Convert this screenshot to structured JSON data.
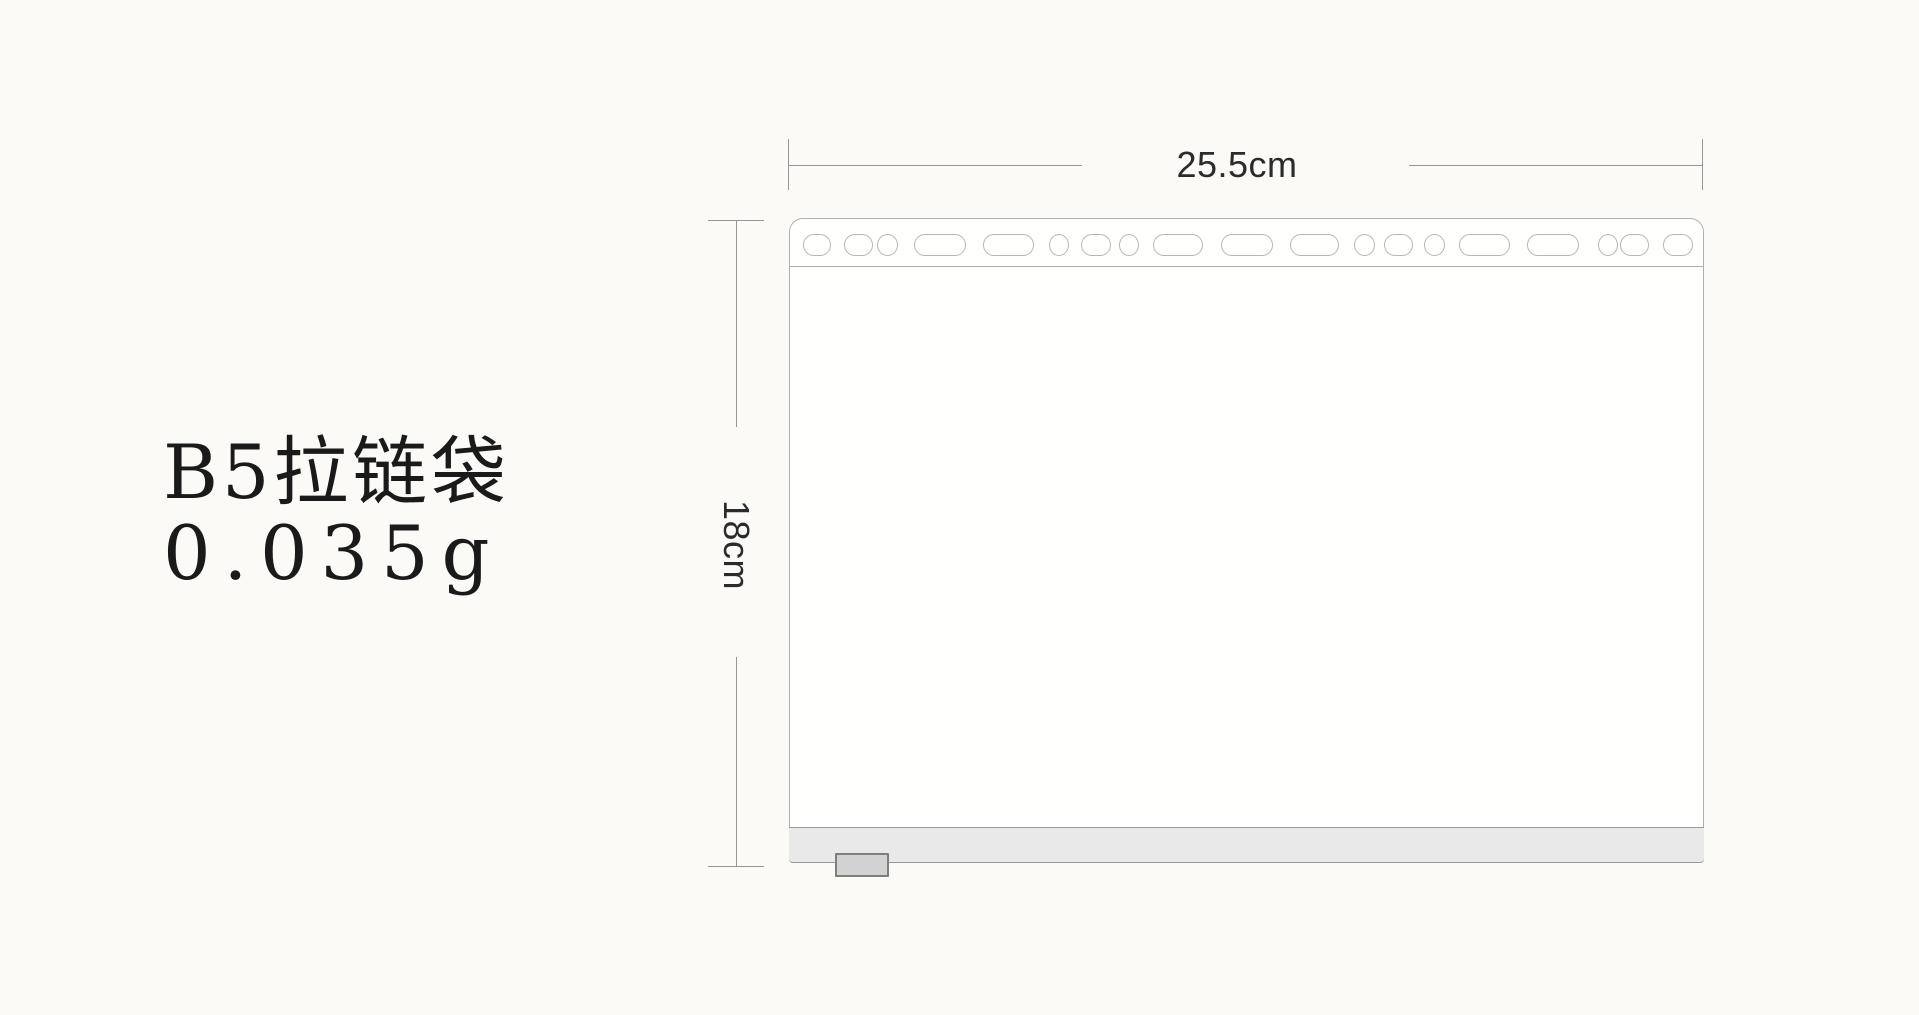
{
  "product": {
    "title": "B5拉链袋",
    "weight": "0.035g"
  },
  "dimensions": {
    "width": {
      "label": "25.5cm"
    },
    "height": {
      "label": "18cm"
    }
  },
  "diagram": {
    "type": "product-dimension-drawing",
    "bag": {
      "description": "B5 zipper bag, front view, multi-punch binder holes on top edge, zipper strip with pull tab at bottom",
      "punch_holes": [
        {
          "shape": "stadium",
          "x": 13,
          "w": 28
        },
        {
          "shape": "stadium",
          "x": 54,
          "w": 29
        },
        {
          "shape": "circle",
          "x": 87,
          "w": 21
        },
        {
          "shape": "wide",
          "x": 124,
          "w": 52
        },
        {
          "shape": "wide",
          "x": 193,
          "w": 51
        },
        {
          "shape": "circle",
          "x": 259,
          "w": 20
        },
        {
          "shape": "stadium",
          "x": 291,
          "w": 30
        },
        {
          "shape": "circle",
          "x": 329,
          "w": 20
        },
        {
          "shape": "wide",
          "x": 363,
          "w": 50
        },
        {
          "shape": "wide",
          "x": 431,
          "w": 52
        },
        {
          "shape": "wide",
          "x": 500,
          "w": 49
        },
        {
          "shape": "circle",
          "x": 564,
          "w": 21
        },
        {
          "shape": "stadium",
          "x": 594,
          "w": 29
        },
        {
          "shape": "circle",
          "x": 634,
          "w": 21
        },
        {
          "shape": "wide",
          "x": 669,
          "w": 51
        },
        {
          "shape": "wide",
          "x": 737,
          "w": 52
        },
        {
          "shape": "circle",
          "x": 808,
          "w": 20
        },
        {
          "shape": "stadium",
          "x": 830,
          "w": 29
        },
        {
          "shape": "stadium",
          "x": 873,
          "w": 30
        }
      ]
    }
  },
  "colors": {
    "background": "#fbfaf6",
    "bag_outline": "#b0b0b0",
    "zipper_strip_fill": "#e9e9e9",
    "zipper_strip_line": "#9a9a9a",
    "tab_fill": "#d2d2d2",
    "tab_border": "#7e7e7e",
    "dimension_line": "#969696",
    "dimension_text": "#2b2b2b",
    "label_text": "#1a1a1a"
  }
}
